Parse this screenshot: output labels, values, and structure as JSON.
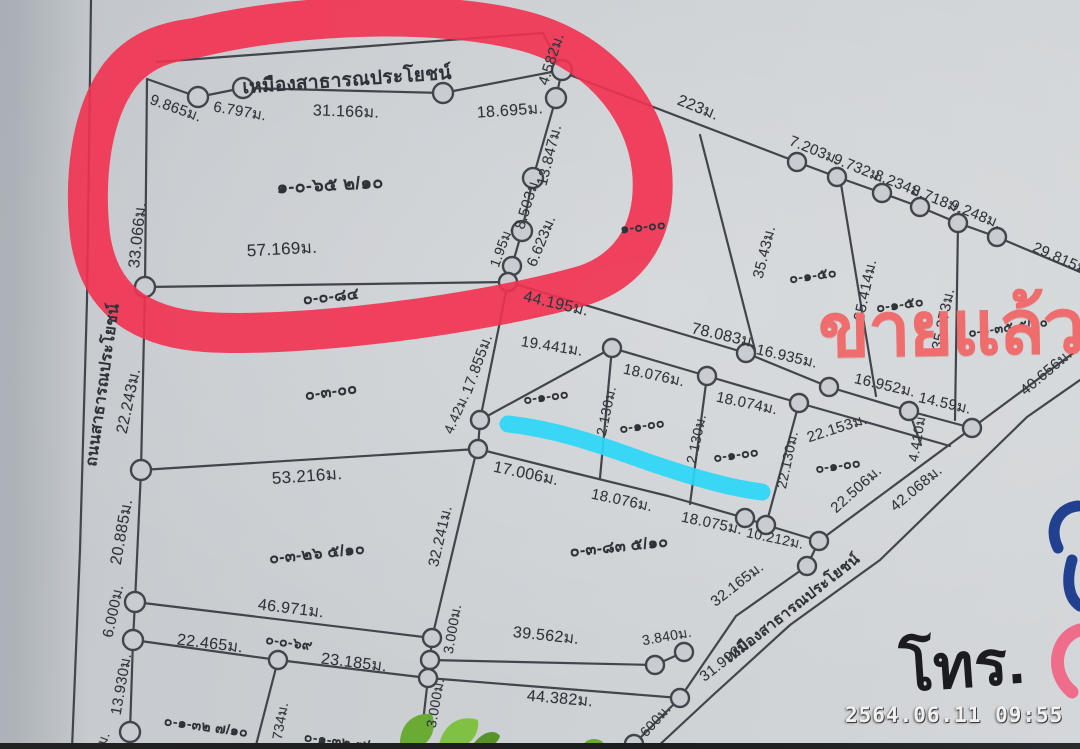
{
  "overlay": {
    "sold_text": "ขายแล้ว",
    "tel_text": "โทร.",
    "timestamp": "2564.06.11 09:55"
  },
  "colors": {
    "paper": "#c7cbcf",
    "line": "#42464c",
    "ink": "#2e3238",
    "red": "#f23150",
    "cyan": "#2bd7f7",
    "sold": "#ef6d6d",
    "tel": "#1b1c20",
    "stamp": "#f0f0f0",
    "bluefrag": "#21408f",
    "pinkfrag": "#ef6d8a"
  },
  "map": {
    "road_label_left": "ถนนสาธารณประโยชน์",
    "canal_label_top": "เหมืองสาธารณประโยชน์",
    "canal_label_bottom": "เหมืองสาธารณประโยชน์",
    "labels": [
      {
        "t": "เหมืองสาธารณประโยชน์",
        "x": 347,
        "y": 80,
        "r": -4,
        "s": 19,
        "k": "n"
      },
      {
        "t": "9.865ม.",
        "x": 176,
        "y": 108,
        "r": 20,
        "s": 15,
        "k": "m"
      },
      {
        "t": "6.797ม.",
        "x": 240,
        "y": 111,
        "r": 10,
        "s": 15,
        "k": "m"
      },
      {
        "t": "31.166ม.",
        "x": 346,
        "y": 112,
        "r": 2,
        "s": 16,
        "k": "m"
      },
      {
        "t": "18.695ม.",
        "x": 510,
        "y": 111,
        "r": -4,
        "s": 16,
        "k": "m"
      },
      {
        "t": "4.582ม.",
        "x": 551,
        "y": 59,
        "r": -72,
        "s": 15,
        "k": "m"
      },
      {
        "t": "33.066ม.",
        "x": 138,
        "y": 235,
        "r": -84,
        "s": 16,
        "k": "m"
      },
      {
        "t": "๑-๐-๖๕ ๒/๑๐",
        "x": 330,
        "y": 184,
        "r": -3,
        "s": 18,
        "k": "p"
      },
      {
        "t": "13.847ม.",
        "x": 549,
        "y": 155,
        "r": -76,
        "s": 15,
        "k": "m"
      },
      {
        "t": "8.503ม.",
        "x": 527,
        "y": 203,
        "r": -73,
        "s": 15,
        "k": "m"
      },
      {
        "t": "1.95ม.",
        "x": 502,
        "y": 247,
        "r": -70,
        "s": 14,
        "k": "m"
      },
      {
        "t": "6.623ม.",
        "x": 541,
        "y": 241,
        "r": -68,
        "s": 15,
        "k": "m"
      },
      {
        "t": "57.169ม.",
        "x": 282,
        "y": 249,
        "r": -3,
        "s": 17,
        "k": "m"
      },
      {
        "t": "๐-๐-๘๔",
        "x": 331,
        "y": 297,
        "r": -6,
        "s": 16,
        "k": "p"
      },
      {
        "t": "223ม.",
        "x": 698,
        "y": 108,
        "r": 22,
        "s": 16,
        "k": "m"
      },
      {
        "t": "7.203ม.",
        "x": 815,
        "y": 150,
        "r": 22,
        "s": 15,
        "k": "m"
      },
      {
        "t": "9.732ม.",
        "x": 859,
        "y": 168,
        "r": 22,
        "s": 15,
        "k": "m"
      },
      {
        "t": "8.234ม.",
        "x": 900,
        "y": 184,
        "r": 22,
        "s": 15,
        "k": "m"
      },
      {
        "t": "8.718ม.",
        "x": 937,
        "y": 199,
        "r": 22,
        "s": 15,
        "k": "m"
      },
      {
        "t": "9.248ม.",
        "x": 976,
        "y": 214,
        "r": 22,
        "s": 15,
        "k": "m"
      },
      {
        "t": "29.815ม.",
        "x": 1062,
        "y": 259,
        "r": 24,
        "s": 15,
        "k": "m"
      },
      {
        "t": "๑-๐-๐๐",
        "x": 643,
        "y": 227,
        "r": -6,
        "s": 14,
        "k": "p"
      },
      {
        "t": "35.43ม.",
        "x": 764,
        "y": 252,
        "r": -76,
        "s": 15,
        "k": "m"
      },
      {
        "t": "๐-๑-๕๐",
        "x": 813,
        "y": 276,
        "r": -8,
        "s": 14,
        "k": "p"
      },
      {
        "t": "35.414ม.",
        "x": 865,
        "y": 290,
        "r": -78,
        "s": 15,
        "k": "m"
      },
      {
        "t": "๐-๑-๕๐",
        "x": 900,
        "y": 305,
        "r": -8,
        "s": 14,
        "k": "p"
      },
      {
        "t": "35.373ม.",
        "x": 943,
        "y": 319,
        "r": -78,
        "s": 15,
        "k": "m"
      },
      {
        "t": "๐-๑-๓๕ ๕/๑๐",
        "x": 1008,
        "y": 327,
        "r": -8,
        "s": 13,
        "k": "p"
      },
      {
        "t": "40.656ม.",
        "x": 1046,
        "y": 372,
        "r": -40,
        "s": 15,
        "k": "m"
      },
      {
        "t": "44.195ม.",
        "x": 556,
        "y": 304,
        "r": 13,
        "s": 16,
        "k": "m"
      },
      {
        "t": "78.083ม.",
        "x": 724,
        "y": 336,
        "r": 13,
        "s": 16,
        "k": "m"
      },
      {
        "t": "16.935ม.",
        "x": 787,
        "y": 356,
        "r": 13,
        "s": 15,
        "k": "m"
      },
      {
        "t": "16.952ม.",
        "x": 885,
        "y": 385,
        "r": 13,
        "s": 15,
        "k": "m"
      },
      {
        "t": "14.59ม.",
        "x": 945,
        "y": 403,
        "r": 13,
        "s": 15,
        "k": "m"
      },
      {
        "t": "19.441ม.",
        "x": 552,
        "y": 346,
        "r": 9,
        "s": 15,
        "k": "m"
      },
      {
        "t": "18.076ม.",
        "x": 654,
        "y": 375,
        "r": 12,
        "s": 15,
        "k": "m"
      },
      {
        "t": "18.074ม.",
        "x": 747,
        "y": 403,
        "r": 12,
        "s": 15,
        "k": "m"
      },
      {
        "t": "22.153ม.",
        "x": 837,
        "y": 428,
        "r": -18,
        "s": 15,
        "k": "m"
      },
      {
        "t": "๐-๑-๐๐",
        "x": 546,
        "y": 397,
        "r": -8,
        "s": 14,
        "k": "p"
      },
      {
        "t": "๐-๑-๐๐",
        "x": 642,
        "y": 426,
        "r": -8,
        "s": 14,
        "k": "p"
      },
      {
        "t": "๐-๑-๐๐",
        "x": 736,
        "y": 455,
        "r": -8,
        "s": 14,
        "k": "p"
      },
      {
        "t": "๐-๑-๐๐",
        "x": 838,
        "y": 466,
        "r": -8,
        "s": 14,
        "k": "p"
      },
      {
        "t": "2.130ม.",
        "x": 607,
        "y": 411,
        "r": -78,
        "s": 14,
        "k": "m"
      },
      {
        "t": "2.130ม.",
        "x": 697,
        "y": 439,
        "r": -78,
        "s": 14,
        "k": "m"
      },
      {
        "t": "22.130ม.",
        "x": 788,
        "y": 460,
        "r": -78,
        "s": 14,
        "k": "m"
      },
      {
        "t": "22.506ม.",
        "x": 856,
        "y": 489,
        "r": -42,
        "s": 15,
        "k": "m"
      },
      {
        "t": "4.410ม.",
        "x": 918,
        "y": 437,
        "r": -80,
        "s": 14,
        "k": "m"
      },
      {
        "t": "17.006ม.",
        "x": 526,
        "y": 474,
        "r": 12,
        "s": 16,
        "k": "m"
      },
      {
        "t": "18.076ม.",
        "x": 622,
        "y": 500,
        "r": 12,
        "s": 15,
        "k": "m"
      },
      {
        "t": "18.075ม.",
        "x": 712,
        "y": 523,
        "r": 12,
        "s": 15,
        "k": "m"
      },
      {
        "t": "10.212ม.",
        "x": 775,
        "y": 539,
        "r": 12,
        "s": 14,
        "k": "m"
      },
      {
        "t": "42.068ม.",
        "x": 916,
        "y": 488,
        "r": -40,
        "s": 15,
        "k": "m"
      },
      {
        "t": "ถนนสาธารณประโยชน์",
        "x": 103,
        "y": 385,
        "r": -82,
        "s": 16,
        "k": "n"
      },
      {
        "t": "22.243ม.",
        "x": 129,
        "y": 401,
        "r": -78,
        "s": 16,
        "k": "m"
      },
      {
        "t": "๐-๓-๐๐",
        "x": 331,
        "y": 392,
        "r": -8,
        "s": 16,
        "k": "p"
      },
      {
        "t": "53.216ม.",
        "x": 307,
        "y": 476,
        "r": -4,
        "s": 17,
        "k": "m"
      },
      {
        "t": "17.855ม.",
        "x": 477,
        "y": 364,
        "r": -70,
        "s": 15,
        "k": "m"
      },
      {
        "t": "4.42ม.",
        "x": 457,
        "y": 414,
        "r": -66,
        "s": 14,
        "k": "m"
      },
      {
        "t": "20.885ม.",
        "x": 122,
        "y": 532,
        "r": -80,
        "s": 16,
        "k": "m"
      },
      {
        "t": "๐-๓-๒๖ ๕/๑๐",
        "x": 317,
        "y": 554,
        "r": -6,
        "s": 16,
        "k": "p"
      },
      {
        "t": "32.241ม.",
        "x": 440,
        "y": 536,
        "r": -77,
        "s": 15,
        "k": "m"
      },
      {
        "t": "46.971ม.",
        "x": 291,
        "y": 609,
        "r": 7,
        "s": 16,
        "k": "m"
      },
      {
        "t": "6.000ม.",
        "x": 113,
        "y": 611,
        "r": -78,
        "s": 15,
        "k": "m"
      },
      {
        "t": "22.465ม.",
        "x": 210,
        "y": 644,
        "r": 7,
        "s": 16,
        "k": "m"
      },
      {
        "t": "๐-๐-๖๙",
        "x": 289,
        "y": 643,
        "r": 8,
        "s": 14,
        "k": "p"
      },
      {
        "t": "23.185ม.",
        "x": 354,
        "y": 663,
        "r": 7,
        "s": 16,
        "k": "m"
      },
      {
        "t": "3.000ม.",
        "x": 453,
        "y": 629,
        "r": -80,
        "s": 14,
        "k": "m"
      },
      {
        "t": "3.000ม.",
        "x": 436,
        "y": 703,
        "r": -80,
        "s": 14,
        "k": "m"
      },
      {
        "t": "13.930ม.",
        "x": 121,
        "y": 684,
        "r": -80,
        "s": 15,
        "k": "m"
      },
      {
        "t": "๐-๑-๓๒ ๗/๑๐",
        "x": 206,
        "y": 727,
        "r": 8,
        "s": 14,
        "k": "p"
      },
      {
        "t": "734ม.",
        "x": 281,
        "y": 721,
        "r": -80,
        "s": 14,
        "k": "m"
      },
      {
        "t": "๐-๑-๓๒ ๗/๑๐",
        "x": 346,
        "y": 743,
        "r": 8,
        "s": 14,
        "k": "p"
      },
      {
        "t": "ม.",
        "x": 104,
        "y": 739,
        "r": -70,
        "s": 14,
        "k": "m"
      },
      {
        "t": "๐-๓-๘๓ ๕/๑๐",
        "x": 619,
        "y": 547,
        "r": -6,
        "s": 16,
        "k": "p"
      },
      {
        "t": "39.562ม.",
        "x": 546,
        "y": 636,
        "r": 6,
        "s": 16,
        "k": "m"
      },
      {
        "t": "3.840ม.",
        "x": 667,
        "y": 637,
        "r": -10,
        "s": 14,
        "k": "m"
      },
      {
        "t": "44.382ม.",
        "x": 560,
        "y": 699,
        "r": 5,
        "s": 16,
        "k": "m"
      },
      {
        "t": "32.165ม.",
        "x": 737,
        "y": 584,
        "r": -38,
        "s": 15,
        "k": "m"
      },
      {
        "t": "31.993ม.",
        "x": 726,
        "y": 659,
        "r": -38,
        "s": 15,
        "k": "m"
      },
      {
        "t": "เหมืองสาธารณประโยชน์",
        "x": 792,
        "y": 608,
        "r": -38,
        "s": 15,
        "k": "n"
      },
      {
        "t": "600ม.",
        "x": 656,
        "y": 721,
        "r": -48,
        "s": 14,
        "k": "m"
      }
    ]
  }
}
